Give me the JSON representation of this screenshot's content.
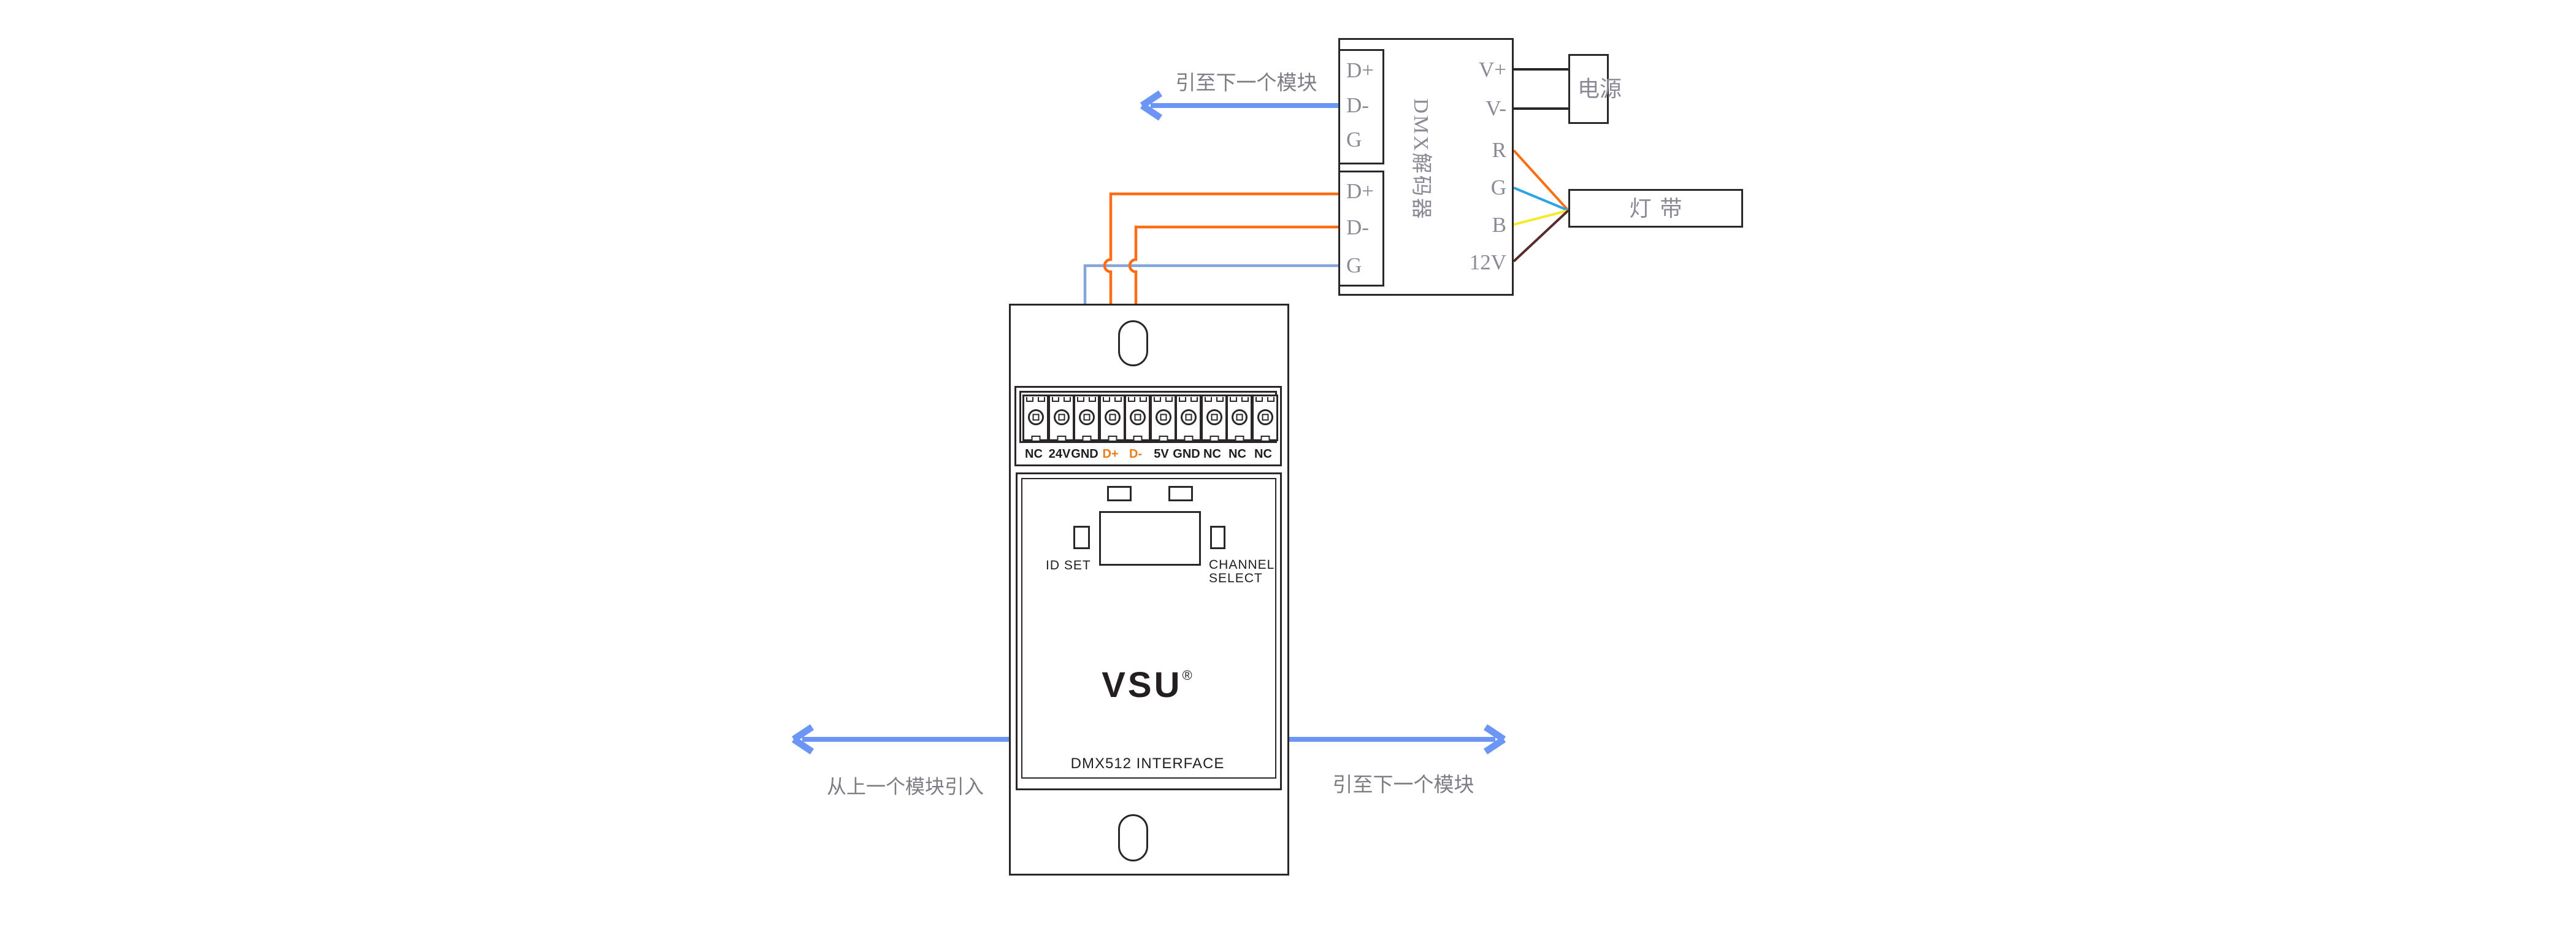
{
  "colors": {
    "line_black": "#2b2727",
    "label_gray": "#8a8a94",
    "note_gray": "#7d7d85",
    "arrow_blue": "#6c96f5",
    "wire_blue_light": "#82a5db",
    "wire_orange": "#ff6c12",
    "wire_green_blue": "#2ba2e8",
    "wire_yellow": "#f6e926",
    "wire_maroon": "#582c2b",
    "wire_black": "#2b2727",
    "terminal_label_orange": "#ed7c1a"
  },
  "decoder": {
    "label_vertical": "DMX解码器",
    "top_block": {
      "terminals": [
        "D+",
        "D-",
        "G"
      ]
    },
    "bottom_block": {
      "terminals": [
        "D+",
        "D-",
        "G"
      ]
    },
    "right_terminals": [
      "V+",
      "V-",
      "R",
      "G",
      "B",
      "12V"
    ]
  },
  "power": {
    "label": "电源"
  },
  "led_strip": {
    "label": "灯带"
  },
  "module": {
    "terminal_labels": [
      "NC",
      "24V",
      "GND",
      "D+",
      "D-",
      "5V",
      "GND",
      "NC",
      "NC",
      "NC"
    ],
    "id_set_label": "ID SET",
    "channel_select_line1": "CHANNEL",
    "channel_select_line2": "SELECT",
    "brand": "VSU",
    "registered_mark": "®",
    "product_label": "DMX512 INTERFACE"
  },
  "annotations": {
    "to_next_module_top": "引至下一个模块",
    "from_previous_module": "从上一个模块引入",
    "to_next_module_bottom": "引至下一个模块"
  }
}
